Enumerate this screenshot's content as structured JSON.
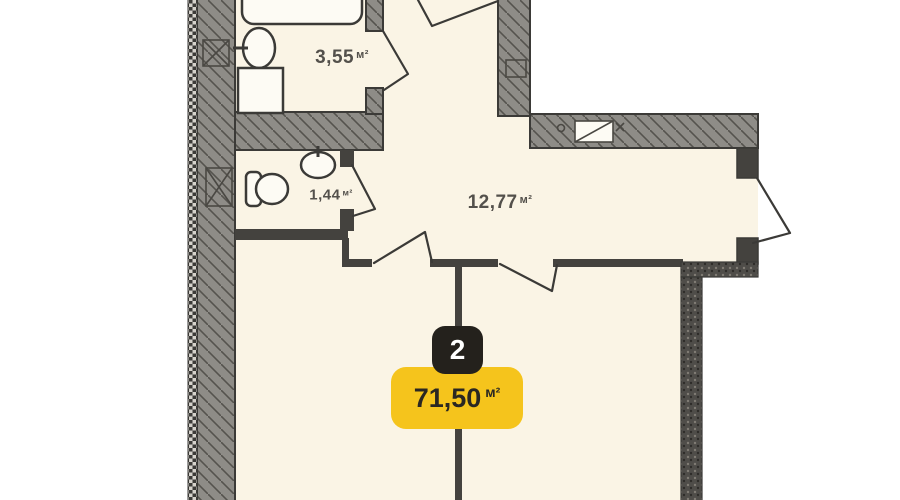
{
  "floor_plan": {
    "unit_badge": {
      "number": "2",
      "area": "71,50",
      "unit": "м²"
    },
    "rooms": [
      {
        "name": "bathroom",
        "area": "3,55",
        "unit": "м²"
      },
      {
        "name": "wc",
        "area": "1,44",
        "unit": "м²"
      },
      {
        "name": "hallway",
        "area": "12,77",
        "unit": "м²"
      }
    ],
    "colors": {
      "room_fill": "#faf4e5",
      "wall_fill": "#8e8c87",
      "wall_line": "#3b3a37",
      "thin_wall": "#44423e",
      "badge_yellow": "#f5c41c",
      "badge_dark": "#24211c",
      "badge_text_light": "#ffffff",
      "badge_text_dark": "#2a2722",
      "label_text": "#53504b"
    }
  }
}
